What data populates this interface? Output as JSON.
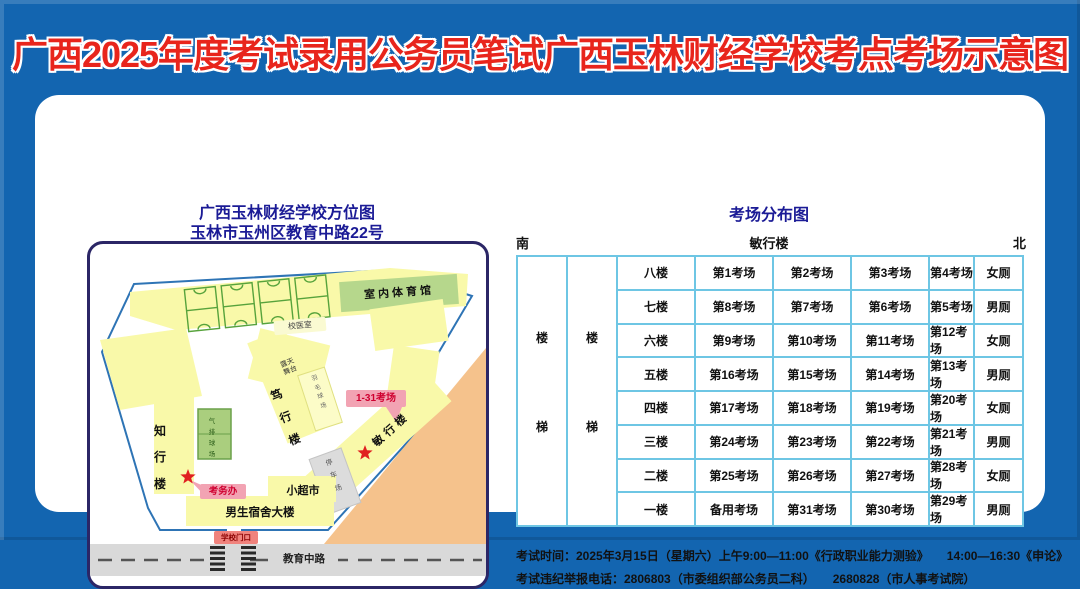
{
  "title": "广西2025年度考试录用公务员笔试广西玉林财经学校考点考场示意图",
  "map_panel": {
    "title_line1": "广西玉林财经学校方位图",
    "title_line2": "玉林市玉州区教育中路22号",
    "labels": {
      "gym": "室内体育馆",
      "clinic": "校医室",
      "zhixing": "知行楼",
      "volleyball": "气排球场",
      "duxing": "笃行楼",
      "stage": "露天舞台",
      "badminton": "羽毛球场",
      "minxing": "敏行楼",
      "rooms": "1-31考场",
      "kaowuban": "考务办",
      "parking": "停车场",
      "supermarket": "小超市",
      "dorm": "男生宿舍大楼",
      "gate": "学校门口",
      "road": "教育中路"
    }
  },
  "table_panel": {
    "title": "考场分布图",
    "south": "南",
    "building": "敏行楼",
    "north": "北",
    "stair_top": "楼",
    "stair_bottom": "梯",
    "rows": [
      {
        "floor": "八楼",
        "cells": [
          "第1考场",
          "第2考场",
          "第3考场",
          "第4考场",
          "女厕"
        ]
      },
      {
        "floor": "七楼",
        "cells": [
          "第8考场",
          "第7考场",
          "第6考场",
          "第5考场",
          "男厕"
        ]
      },
      {
        "floor": "六楼",
        "cells": [
          "第9考场",
          "第10考场",
          "第11考场",
          "第12考场",
          "女厕"
        ]
      },
      {
        "floor": "五楼",
        "cells": [
          "第16考场",
          "第15考场",
          "第14考场",
          "第13考场",
          "男厕"
        ]
      },
      {
        "floor": "四楼",
        "cells": [
          "第17考场",
          "第18考场",
          "第19考场",
          "第20考场",
          "女厕"
        ]
      },
      {
        "floor": "三楼",
        "cells": [
          "第24考场",
          "第23考场",
          "第22考场",
          "第21考场",
          "男厕"
        ]
      },
      {
        "floor": "二楼",
        "cells": [
          "第25考场",
          "第26考场",
          "第27考场",
          "第28考场",
          "女厕"
        ]
      },
      {
        "floor": "一楼",
        "cells": [
          "备用考场",
          "第31考场",
          "第30考场",
          "第29考场",
          "男厕"
        ]
      }
    ]
  },
  "footer": {
    "line1": "考试时间：2025年3月15日（星期六）上午9:00—11:00《行政职业能力测验》　　14:00—16:30《申论》",
    "line2": "考试违纪举报电话：2806803（市委组织部公务员二科）　　2680828（市人事考试院）"
  },
  "colors": {
    "bg_blue": "#1365b0",
    "title_red": "#e8251c",
    "navy": "#1b1b96",
    "map_border": "#2b2666",
    "boundary": "#2e74b5",
    "yellow": "#f9f9a9",
    "gym_green": "#b6d78c",
    "court_green": "#57a33c",
    "pink_bg": "#f2a3b3",
    "pink_text": "#cf0030",
    "gate_bg": "#f0837d",
    "gate_text": "#8b0000",
    "road_gray": "#d9d9d9",
    "parking_gray": "#dcdcdc",
    "orange": "#f5c28c",
    "table_border": "#6ec6e4",
    "star_red": "#e02020",
    "text_dark": "#111111"
  }
}
